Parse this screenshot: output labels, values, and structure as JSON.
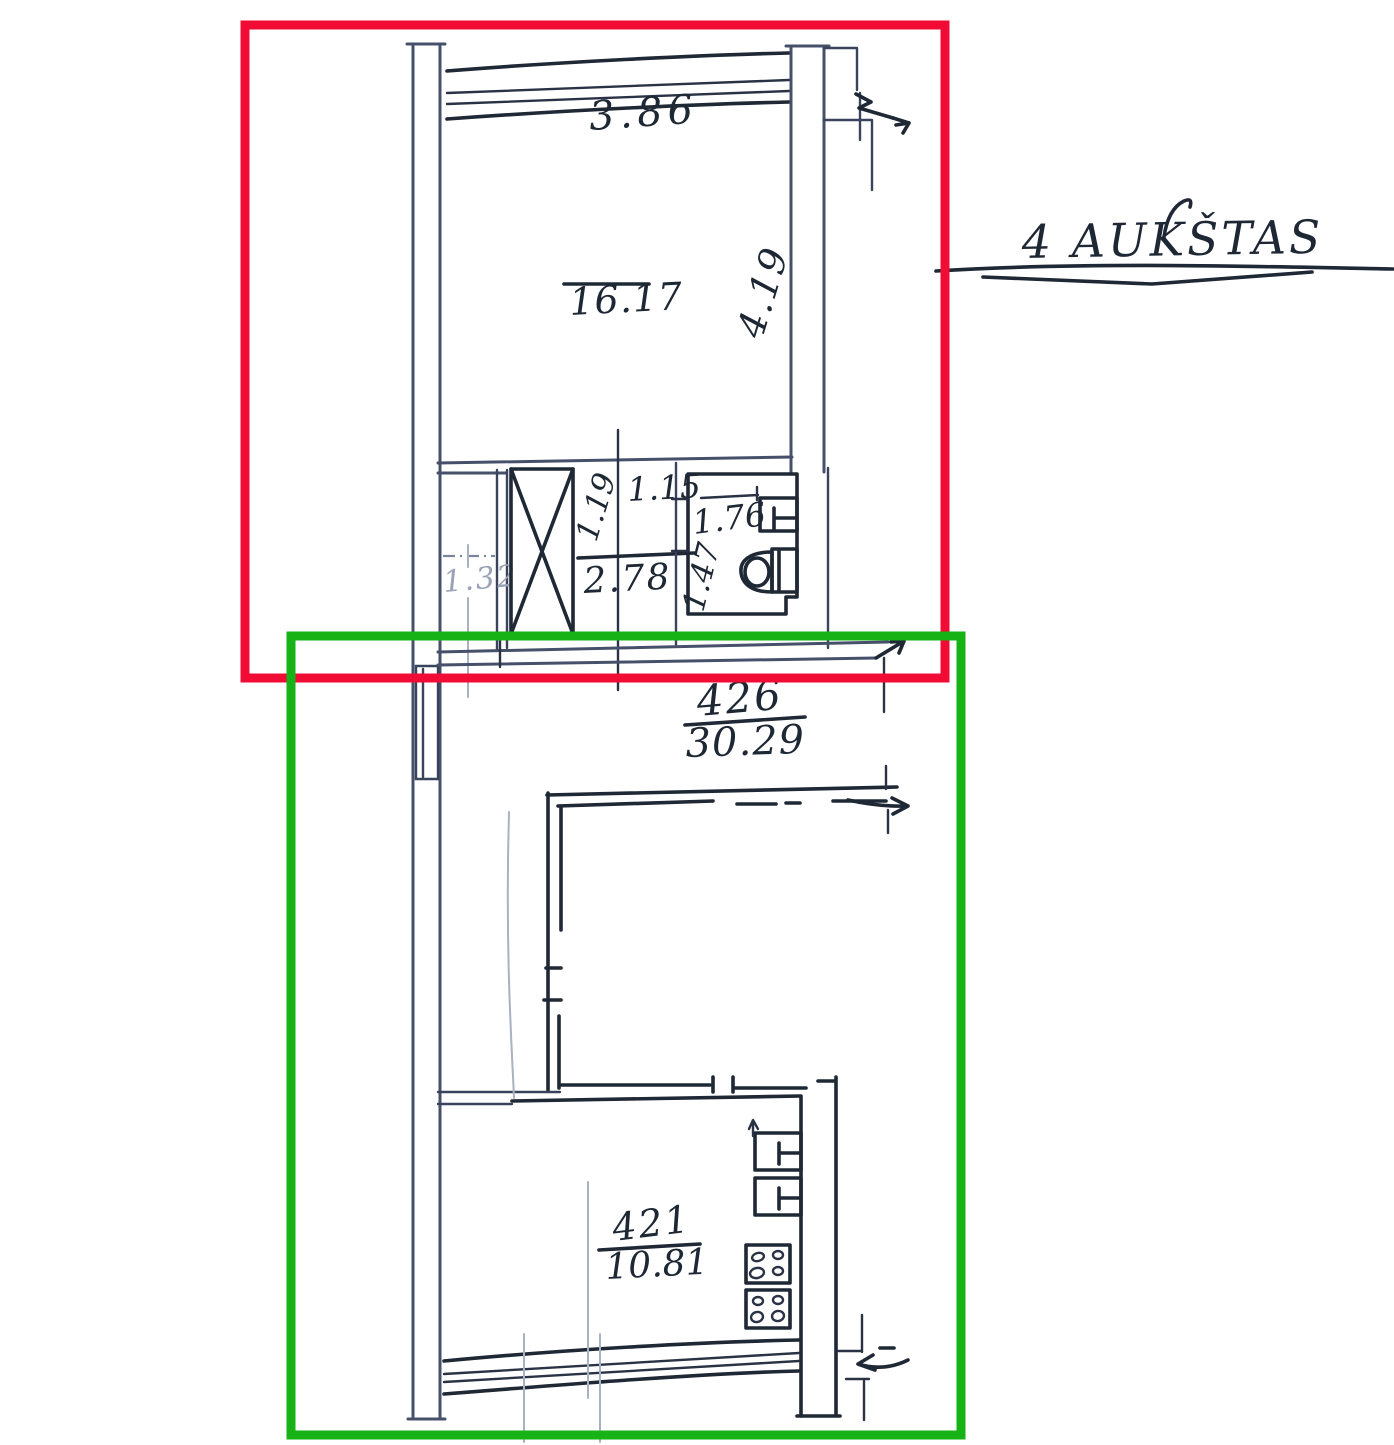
{
  "drawing_type": "apartment floor plan (hand-drawn blueprint)",
  "labels": {
    "floor_title": "4 AUKŠTAS",
    "room_width": "3.86",
    "room_area": "16.17",
    "room_depth": "4.19",
    "hall_opening_width": "1.15",
    "shaft_depth": "1.19",
    "closet_width": "1.32",
    "hall_area": "2.78",
    "wc_width": "1.76",
    "wc_depth": "1.47",
    "apartment_number": "426",
    "apartment_area": "30.29",
    "kitchen_number": "421",
    "kitchen_area": "10.81"
  },
  "icons": {
    "toilet": "toilet-icon (bowl + cistern outline)",
    "wash_basin": "sink-icon (rectangle with T tap)",
    "stove": "stove-icon (square with 4 burner rings)",
    "ventilation_shaft": "crossed-box-icon (rectangle with X)",
    "window": "window-lines-icon (4 parallel lines in wall)",
    "wall_break": "break-arrow-icon (zigzag continuation arrow)"
  },
  "annotations": {
    "upper_selection_color": "#f10c35",
    "lower_selection_color": "#16b216"
  },
  "colors": {
    "ink": "#1f2835",
    "wall": "#46506a",
    "paper": "#ffffff"
  }
}
